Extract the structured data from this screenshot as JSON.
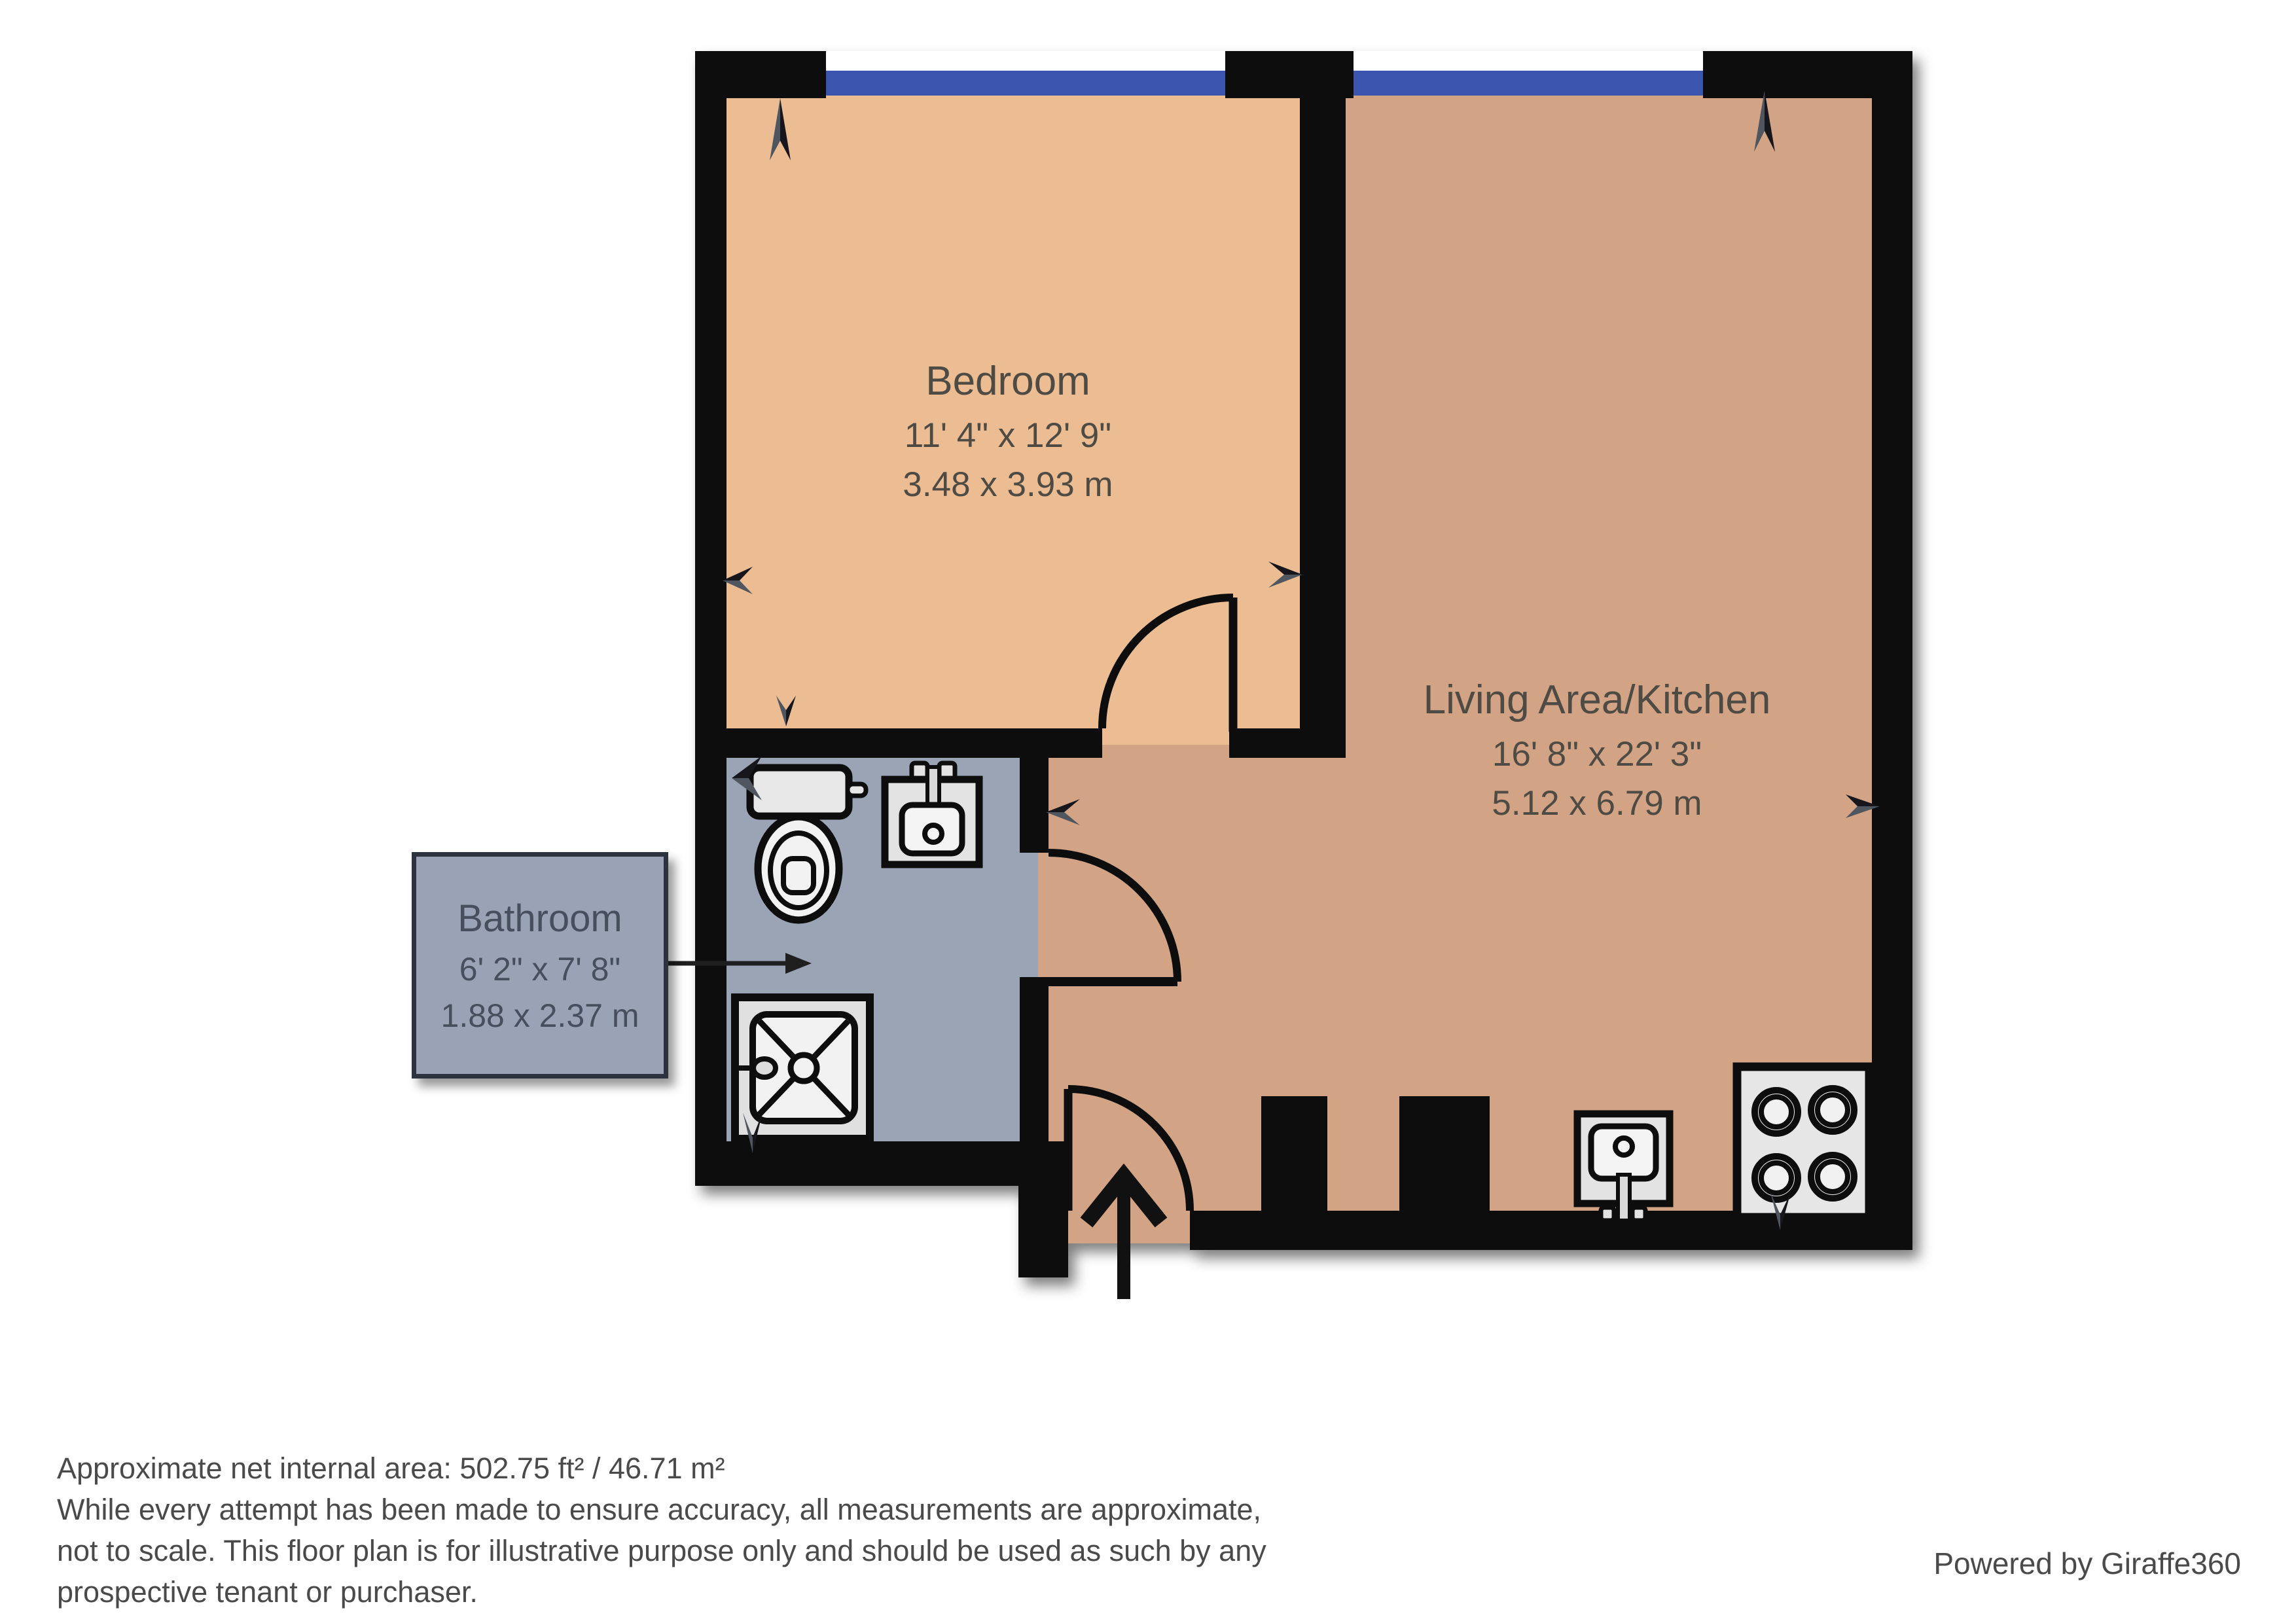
{
  "rooms": {
    "bedroom": {
      "name": "Bedroom",
      "imperial": "11' 4\" x 12' 9\"",
      "metric": "3.48 x 3.93 m"
    },
    "living": {
      "name": "Living Area/Kitchen",
      "imperial": "16' 8\" x 22' 3\"",
      "metric": "5.12 x 6.79 m"
    },
    "bathroom": {
      "name": "Bathroom",
      "imperial": "6' 2\" x 7' 8\"",
      "metric": "1.88 x 2.37 m"
    }
  },
  "fixtures": [
    "toilet",
    "bathroom-sink",
    "shower",
    "kitchen-sink",
    "hob"
  ],
  "footer": {
    "area": "Approximate net internal area: 502.75 ft² / 46.71 m²",
    "disclaimer1": "While every attempt has been made to ensure accuracy, all measurements are approximate,",
    "disclaimer2": "not to scale. This floor plan is for illustrative purpose only and should be used as such by any",
    "disclaimer3": "prospective tenant or purchaser."
  },
  "branding": {
    "powered_by": "Powered by Giraffe360"
  },
  "colors": {
    "bedroom_floor": "#ECBC92",
    "living_floor": "#D2A384",
    "bathroom_floor": "#9BA4B4",
    "wall": "#0A0A0A",
    "window": "#3A55AE",
    "label_box_fill": "#9AA3B5",
    "label_box_border": "#2D333E",
    "room_label_text": "#4E4A44",
    "footer_text": "#4A4A4A"
  }
}
